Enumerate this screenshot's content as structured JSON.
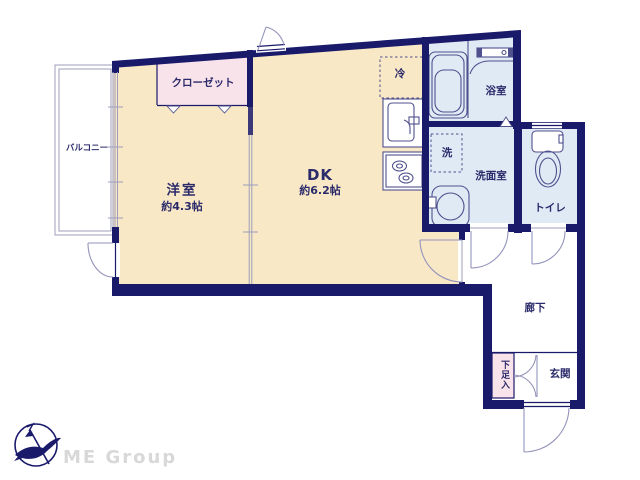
{
  "colors": {
    "wall": "#1a1a6b",
    "cream": "#f8e8c6",
    "pink": "#f9e3ea",
    "blue": "#dfeaf5",
    "text": "#2b2b6b",
    "line": "#9393bb",
    "fixture": "#50508e",
    "gray": "#9d9dbb",
    "logogray": "#d8d8d8"
  },
  "rooms": {
    "bedroom": {
      "label": "洋室",
      "area": "約4.3帖"
    },
    "dk": {
      "label": "DK",
      "area": "約6.2帖"
    },
    "closet": {
      "label": "クローゼット"
    },
    "balcony": {
      "label": "バルコニー"
    },
    "fridge": {
      "label": "冷"
    },
    "bathroom": {
      "label": "浴室"
    },
    "laundry": {
      "label": "洗"
    },
    "washroom": {
      "label": "洗面室"
    },
    "toilet": {
      "label": "トイレ"
    },
    "hallway": {
      "label": "廊下"
    },
    "entrance": {
      "label": "玄関"
    },
    "shoebox": {
      "label": "下足入"
    }
  },
  "logo": {
    "brand": "ME Group"
  }
}
